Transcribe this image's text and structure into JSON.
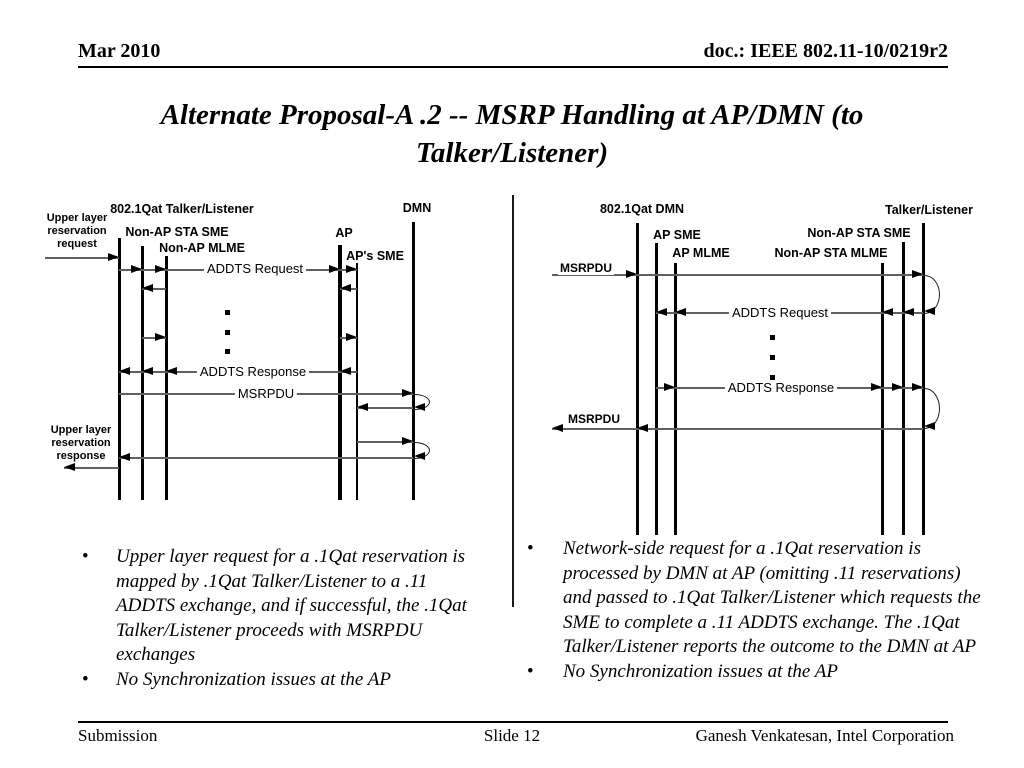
{
  "header": {
    "date": "Mar 2010",
    "doc": "doc.: IEEE 802.11-10/0219r2"
  },
  "title": "Alternate Proposal-A .2 -- MSRP Handling at AP/DMN (to Talker/Listener)",
  "footer": {
    "left": "Submission",
    "center": "Slide 12",
    "right": "Ganesh Venkatesan, Intel Corporation"
  },
  "left_notes": {
    "items": [
      "Upper layer request for a .1Qat reservation is mapped by .1Qat Talker/Listener to a .11 ADDTS exchange, and if successful, the .1Qat Talker/Listener proceeds with MSRPDU exchanges",
      "No Synchronization issues at the AP"
    ]
  },
  "right_notes": {
    "items": [
      "Network-side request for a .1Qat reservation is processed by DMN at AP (omitting .11 reservations) and passed to .1Qat Talker/Listener which requests the SME to complete a .11 ADDTS exchange. The .1Qat Talker/Listener reports the outcome to the DMN at AP",
      "No Synchronization issues at the AP"
    ]
  },
  "diagram": {
    "colors": {
      "line": "#606060",
      "ink": "#000000"
    },
    "lifelines": [
      {
        "name": "tl-entity",
        "x": 119,
        "y1": 238,
        "y2": 500,
        "w": 3
      },
      {
        "name": "non-ap-sta-sme",
        "x": 142,
        "y1": 246,
        "y2": 500,
        "w": 3
      },
      {
        "name": "non-ap-mlme",
        "x": 166,
        "y1": 256,
        "y2": 500,
        "w": 3
      },
      {
        "name": "ap",
        "x": 340,
        "y1": 245,
        "y2": 500,
        "w": 4
      },
      {
        "name": "aps-sme",
        "x": 357,
        "y1": 263,
        "y2": 500,
        "w": 1.5
      },
      {
        "name": "dmn",
        "x": 413,
        "y1": 222,
        "y2": 500,
        "w": 3
      },
      {
        "name": "dmn-right",
        "x": 637,
        "y1": 223,
        "y2": 535,
        "w": 3
      },
      {
        "name": "ap-sme-right",
        "x": 656,
        "y1": 243,
        "y2": 535,
        "w": 3
      },
      {
        "name": "ap-mlme-right",
        "x": 675,
        "y1": 263,
        "y2": 535,
        "w": 3
      },
      {
        "name": "sta-mlme-right",
        "x": 882,
        "y1": 263,
        "y2": 535,
        "w": 3
      },
      {
        "name": "sta-sme-right",
        "x": 903,
        "y1": 242,
        "y2": 535,
        "w": 3
      },
      {
        "name": "talker-listener",
        "x": 923,
        "y1": 223,
        "y2": 535,
        "w": 3
      }
    ],
    "labels": [
      {
        "name": "label-qat-talker-listener",
        "cls": "entity",
        "x": 182,
        "y": 202,
        "text": "802.1Qat Talker/Listener"
      },
      {
        "name": "label-upper-layer-request",
        "cls": "side",
        "x": 77,
        "y": 212,
        "text": "Upper layer\nreservation\nrequest"
      },
      {
        "name": "label-non-ap-sta-sme",
        "cls": "entity",
        "x": 177,
        "y": 225,
        "text": "Non-AP STA SME"
      },
      {
        "name": "label-non-ap-mlme",
        "cls": "entity",
        "x": 202,
        "y": 241,
        "text": "Non-AP MLME"
      },
      {
        "name": "label-ap",
        "cls": "entity",
        "x": 344,
        "y": 226,
        "text": "AP"
      },
      {
        "name": "label-aps-sme",
        "cls": "entity",
        "x": 375,
        "y": 249,
        "text": "AP's SME"
      },
      {
        "name": "label-dmn",
        "cls": "entity",
        "x": 417,
        "y": 201,
        "text": "DMN"
      },
      {
        "name": "label-addts-request-left",
        "cls": "msg",
        "x": 255,
        "y": 262,
        "text": "ADDTS Request"
      },
      {
        "name": "label-addts-response-left",
        "cls": "msg",
        "x": 253,
        "y": 365,
        "text": "ADDTS Response"
      },
      {
        "name": "label-msrpdu-left",
        "cls": "msg",
        "x": 266,
        "y": 387,
        "text": "MSRPDU"
      },
      {
        "name": "label-upper-layer-response",
        "cls": "side",
        "x": 81,
        "y": 424,
        "text": "Upper layer\nreservation\nresponse"
      },
      {
        "name": "label-qat-dmn",
        "cls": "entity",
        "x": 642,
        "y": 202,
        "text": "802.1Qat DMN"
      },
      {
        "name": "label-talker-listener",
        "cls": "entity",
        "x": 929,
        "y": 203,
        "text": "Talker/Listener"
      },
      {
        "name": "label-ap-sme",
        "cls": "entity",
        "x": 677,
        "y": 228,
        "text": "AP SME"
      },
      {
        "name": "label-ap-mlme",
        "cls": "entity",
        "x": 701,
        "y": 246,
        "text": "AP MLME"
      },
      {
        "name": "label-non-ap-sta-sme-r",
        "cls": "entity",
        "x": 859,
        "y": 226,
        "text": "Non-AP STA SME"
      },
      {
        "name": "label-non-ap-sta-mlme-r",
        "cls": "entity",
        "x": 831,
        "y": 246,
        "text": "Non-AP STA MLME"
      },
      {
        "name": "label-msrpdu-in",
        "cls": "msgb",
        "x": 586,
        "y": 262,
        "text": "MSRPDU"
      },
      {
        "name": "label-addts-request-right",
        "cls": "msg",
        "x": 780,
        "y": 306,
        "text": "ADDTS Request"
      },
      {
        "name": "label-addts-response-right",
        "cls": "msg",
        "x": 781,
        "y": 381,
        "text": "ADDTS Response"
      },
      {
        "name": "label-msrpdu-out",
        "cls": "msgb",
        "x": 594,
        "y": 413,
        "text": "MSRPDU"
      }
    ],
    "arrows": [
      {
        "x1": 45,
        "x2": 119,
        "y": 258
      },
      {
        "x1": 119,
        "x2": 142,
        "y": 270
      },
      {
        "x1": 142,
        "x2": 166,
        "y": 270
      },
      {
        "x1": 166,
        "x2": 340,
        "y": 270
      },
      {
        "x1": 340,
        "x2": 357,
        "y": 270
      },
      {
        "x1": 166,
        "x2": 142,
        "y": 289
      },
      {
        "x1": 357,
        "x2": 340,
        "y": 289
      },
      {
        "x1": 142,
        "x2": 166,
        "y": 338
      },
      {
        "x1": 340,
        "x2": 357,
        "y": 338
      },
      {
        "x1": 357,
        "x2": 340,
        "y": 372
      },
      {
        "x1": 340,
        "x2": 166,
        "y": 372
      },
      {
        "x1": 166,
        "x2": 142,
        "y": 372
      },
      {
        "x1": 142,
        "x2": 119,
        "y": 372
      },
      {
        "x1": 119,
        "x2": 413,
        "y": 394
      },
      {
        "x1": 413,
        "x2": 357,
        "y": 408
      },
      {
        "x1": 357,
        "x2": 413,
        "y": 442
      },
      {
        "x1": 413,
        "x2": 119,
        "y": 458
      },
      {
        "x1": 119,
        "x2": 64,
        "y": 468
      },
      {
        "x1": 552,
        "x2": 637,
        "y": 275
      },
      {
        "x1": 637,
        "x2": 923,
        "y": 275
      },
      {
        "x1": 923,
        "x2": 903,
        "y": 313
      },
      {
        "x1": 903,
        "x2": 882,
        "y": 313
      },
      {
        "x1": 882,
        "x2": 675,
        "y": 313
      },
      {
        "x1": 675,
        "x2": 656,
        "y": 313
      },
      {
        "x1": 656,
        "x2": 675,
        "y": 388
      },
      {
        "x1": 675,
        "x2": 882,
        "y": 388
      },
      {
        "x1": 882,
        "x2": 903,
        "y": 388
      },
      {
        "x1": 903,
        "x2": 923,
        "y": 388
      },
      {
        "x1": 923,
        "x2": 637,
        "y": 429
      },
      {
        "x1": 637,
        "x2": 552,
        "y": 429
      }
    ],
    "loops": [
      {
        "x": 413,
        "y1": 394,
        "y2": 408
      },
      {
        "x": 413,
        "y1": 442,
        "y2": 457
      },
      {
        "x": 923,
        "y1": 275,
        "y2": 312
      },
      {
        "x": 923,
        "y1": 388,
        "y2": 427
      }
    ],
    "dots": [
      {
        "x": 225,
        "y": 310
      },
      {
        "x": 225,
        "y": 330
      },
      {
        "x": 225,
        "y": 349
      },
      {
        "x": 770,
        "y": 335
      },
      {
        "x": 770,
        "y": 355
      },
      {
        "x": 770,
        "y": 375
      }
    ]
  }
}
